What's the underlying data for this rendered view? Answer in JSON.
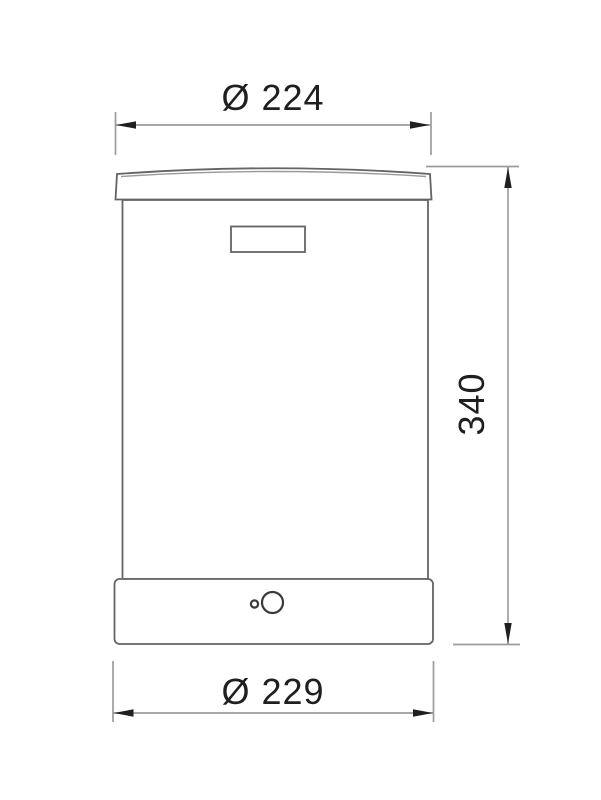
{
  "drawing": {
    "kind": "technical-dimension-drawing",
    "view": "front-elevation"
  },
  "dimensions": {
    "top_diameter": {
      "label": "Ø 224",
      "value": 224
    },
    "height": {
      "label": "340",
      "value": 340
    },
    "bottom_diameter": {
      "label": "Ø 229",
      "value": 229
    }
  },
  "colors": {
    "background": "#ffffff",
    "object_line": "#646464",
    "dimension_line": "#8c8c8c",
    "extension_line": "#9c9c9c",
    "arrow": "#1f1f1f",
    "text": "#1f1f1f"
  }
}
